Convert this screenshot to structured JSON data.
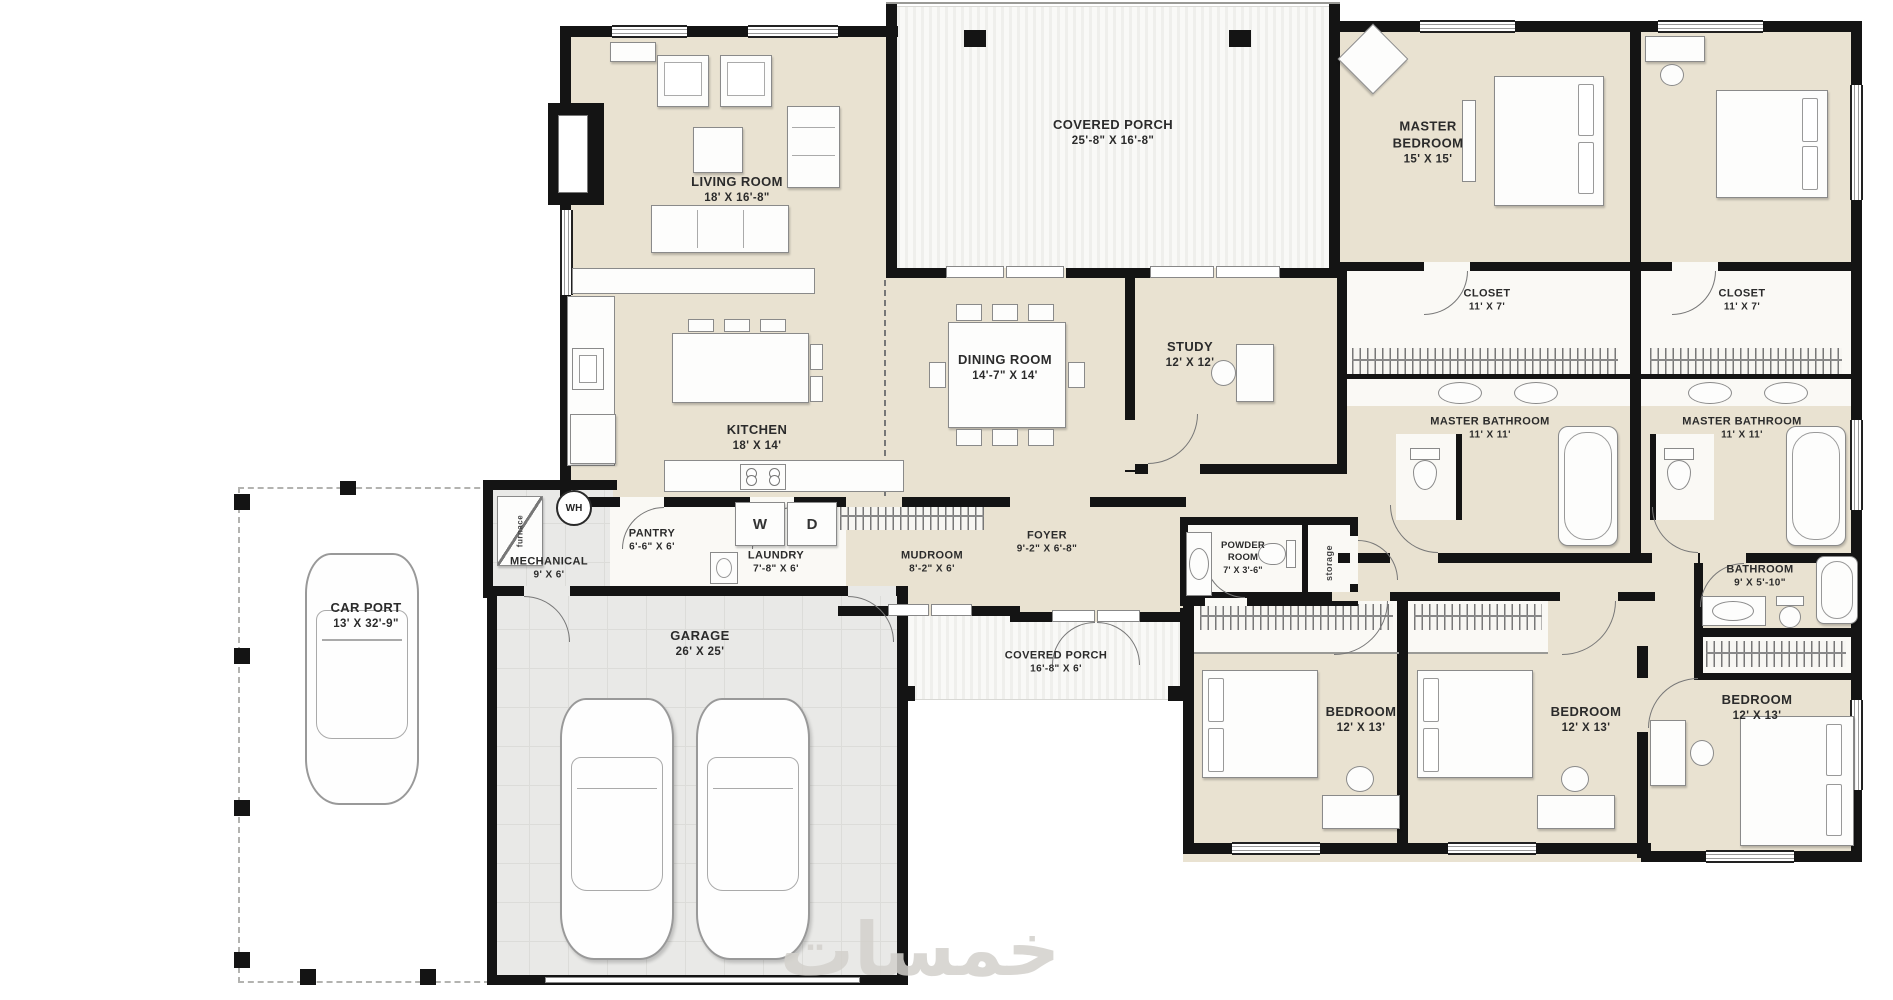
{
  "rooms": {
    "living": {
      "name": "LIVING ROOM",
      "dims": "18' X 16'-8\""
    },
    "porch_top": {
      "name": "COVERED PORCH",
      "dims": "25'-8\" X 16'-8\""
    },
    "master_bedroom": {
      "name": "MASTER BEDROOM",
      "dims": "15' X 15'"
    },
    "kitchen": {
      "name": "KITCHEN",
      "dims": "18' X 14'"
    },
    "dining": {
      "name": "DINING ROOM",
      "dims": "14'-7\" X 14'"
    },
    "study": {
      "name": "STUDY",
      "dims": "12' X 12'"
    },
    "closet_l": {
      "name": "CLOSET",
      "dims": "11' X 7'"
    },
    "closet_r": {
      "name": "CLOSET",
      "dims": "11' X 7'"
    },
    "bath_l": {
      "name": "MASTER BATHROOM",
      "dims": "11' X 11'"
    },
    "bath_r": {
      "name": "MASTER BATHROOM",
      "dims": "11' X 11'"
    },
    "pantry": {
      "name": "PANTRY",
      "dims": "6'-6\" X 6'"
    },
    "laundry": {
      "name": "LAUNDRY",
      "dims": "7'-8\" X 6'"
    },
    "mudroom": {
      "name": "MUDROOM",
      "dims": "8'-2\" X 6'"
    },
    "foyer": {
      "name": "FOYER",
      "dims": "9'-2\" X 6'-8\""
    },
    "mechanical": {
      "name": "MECHANICAL",
      "dims": "9' X 6'"
    },
    "carport": {
      "name": "CAR PORT",
      "dims": "13' X 32'-9\""
    },
    "garage": {
      "name": "GARAGE",
      "dims": "26' X 25'"
    },
    "porch_bottom": {
      "name": "COVERED PORCH",
      "dims": "16'-8\" X 6'"
    },
    "powder": {
      "name": "POWDER ROOM",
      "dims": "7' X 3'-6\""
    },
    "bathroom3": {
      "name": "BATHROOM",
      "dims": "9' X 5'-10\""
    },
    "bedroom1": {
      "name": "BEDROOM",
      "dims": "12' X 13'"
    },
    "bedroom2": {
      "name": "BEDROOM",
      "dims": "12' X 13'"
    },
    "bedroom3": {
      "name": "BEDROOM",
      "dims": "12' X 13'"
    }
  },
  "fixtures": {
    "washer": "W",
    "dryer": "D",
    "water_heater": "WH",
    "furnace": "furnace",
    "storage": "storage"
  },
  "watermark": {
    "text": "خمسات"
  },
  "colors": {
    "floor": "#e9e2d1",
    "wall": "#141414",
    "white-room": "#faf9f5",
    "garage-floor": "#e9e9e7",
    "grid-line": "#dcdcd9",
    "label": "#2b2b2b"
  }
}
